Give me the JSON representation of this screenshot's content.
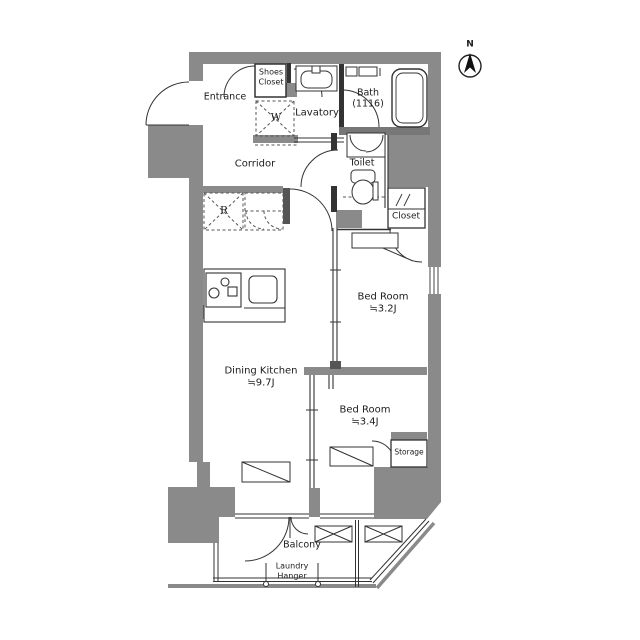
{
  "title": "Apartment floor plan",
  "compass": {
    "north_label": "N"
  },
  "rooms": {
    "entrance": "Entrance",
    "shoes_closet_line1": "Shoes",
    "shoes_closet_line2": "Closet",
    "washer_mark": "W",
    "lavatory": "Lavatory",
    "bath": "Bath",
    "bath_size": "(1116)",
    "toilet": "Toilet",
    "closet": "Closet",
    "corridor": "Corridor",
    "fridge_mark": "R",
    "bedroom1": "Bed Room",
    "bedroom1_size": "≒3.2J",
    "dining_kitchen": "Dining Kitchen",
    "dining_kitchen_size": "≒9.7J",
    "bedroom2": "Bed Room",
    "bedroom2_size": "≒3.4J",
    "storage": "Storage",
    "balcony": "Balcony",
    "laundry_line1": "Laundry",
    "laundry_line2": "Hanger"
  },
  "colors": {
    "wall": "#8a8a8a",
    "line": "#333333",
    "dark": "#555555",
    "bg": "#ffffff"
  }
}
